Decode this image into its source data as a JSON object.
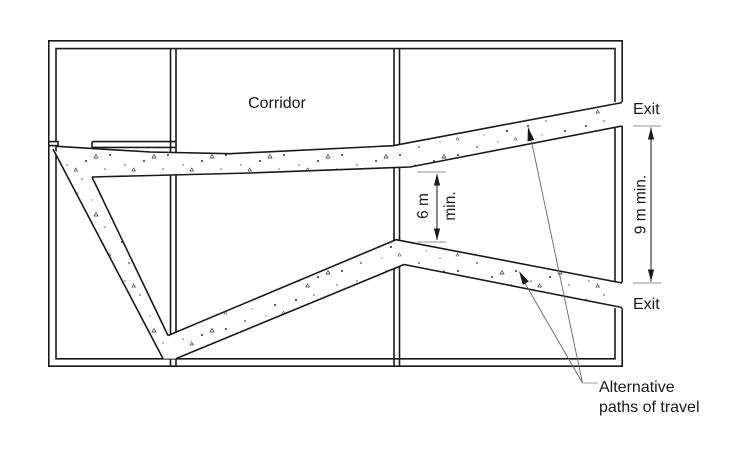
{
  "diagram": {
    "corridor": {
      "label": "Corridor"
    },
    "exits": {
      "top_label": "Exit",
      "bottom_label": "Exit"
    },
    "dimensions": {
      "path_separation": {
        "value": "6 m",
        "qualifier": "min."
      },
      "exit_spacing": {
        "label": "9 m min."
      }
    },
    "annotation": {
      "line1": "Alternative",
      "line2": "paths of travel"
    },
    "colors": {
      "line": "#1a1a1a",
      "extension_line": "#a6a6a6",
      "leader_line": "#666666",
      "background": "#ffffff"
    }
  }
}
